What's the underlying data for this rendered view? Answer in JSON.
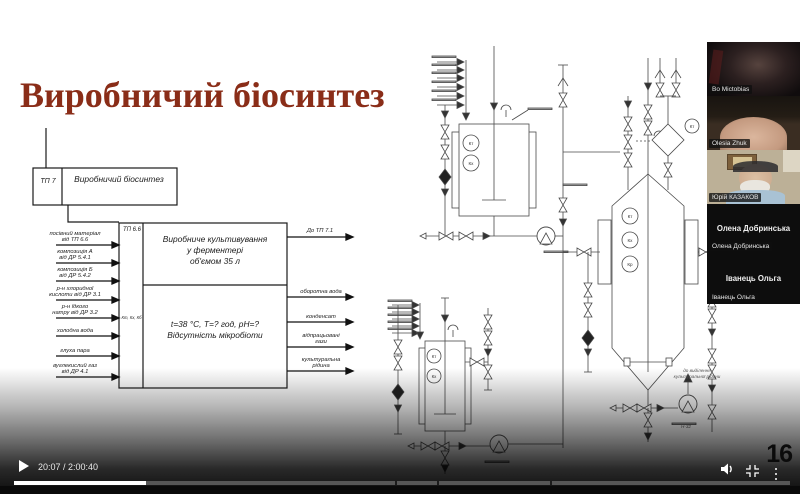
{
  "slide": {
    "title": "Виробничий біосинтез",
    "flow": {
      "parent_tag": "ТП 7",
      "parent_name": "Виробничий біосинтез",
      "block_tag": "ТП 6.6",
      "control_points": "Кт, Кх, Кб",
      "process_line1": "Виробниче культивування",
      "process_line2": "у ферментері",
      "process_line3": "об'ємом 35 л",
      "conditions_line1": "t=38 °С, Т=? год, рН=?",
      "conditions_line2": "Відсутність мікробіоти",
      "output_top": "До ТП 7.1",
      "inputs": [
        {
          "line1": "посівний матеріал",
          "line2": "від ТП 6.6"
        },
        {
          "line1": "композиція А",
          "line2": "від ДР 5.4.1"
        },
        {
          "line1": "композиція Б",
          "line2": "від ДР 5.4.2"
        },
        {
          "line1": "р-н хлоридної",
          "line2": "кислоти від ДР 3.1"
        },
        {
          "line1": "р-н їдкого",
          "line2": "натру від ДР 3.2"
        },
        {
          "line1": "холодна вода",
          "line2": ""
        },
        {
          "line1": "глуха пара",
          "line2": ""
        },
        {
          "line1": "вуглекислий газ",
          "line2": "від ДР 4.1"
        }
      ],
      "outputs": [
        {
          "line1": "оборотна вода",
          "line2": ""
        },
        {
          "line1": "конденсат",
          "line2": ""
        },
        {
          "line1": "відпрацьовані",
          "line2": "гази"
        },
        {
          "line1": "культуральна",
          "line2": "рідина"
        }
      ]
    },
    "pid": {
      "seed_instruments": [
        "Кт",
        "Кх"
      ],
      "fermenter_instruments": [
        "Кт",
        "Кх",
        "Кр"
      ],
      "inoculator_instruments": [
        "Кт",
        "Кх"
      ],
      "filter_instrument": "Кт",
      "note_line1": "до виділення",
      "note_line2": "культуральної рідини",
      "pump_tag": "Н-32"
    }
  },
  "participants": [
    {
      "name": "Bo Mictobias"
    },
    {
      "name": "Olesia Zhuk"
    },
    {
      "name": "Юрій КАЗАКОВ"
    },
    {
      "name": "Олена Добринська"
    },
    {
      "name": "Іванець Ольга"
    }
  ],
  "player": {
    "time_display": "20:07 / 2:00:40",
    "page_number": "16",
    "progress_percent": 17
  }
}
